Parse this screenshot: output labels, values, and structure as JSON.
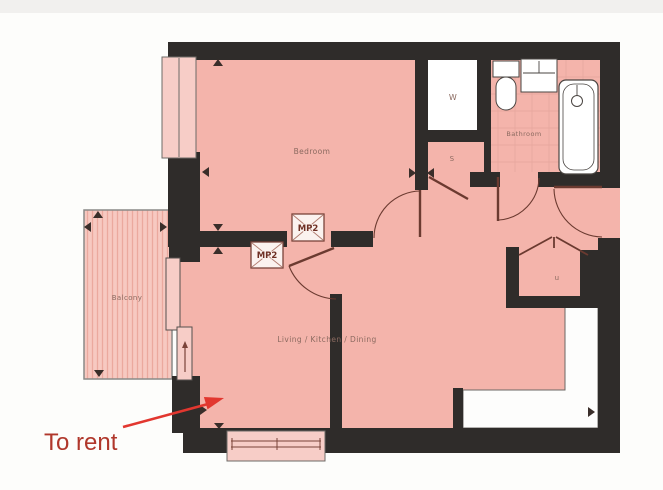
{
  "annotation": {
    "text": "To rent"
  },
  "rooms": {
    "bedroom": "Bedroom",
    "bathroom": "Bathroom",
    "balcony": "Balcony",
    "living": "Living / Kitchen / Dining"
  },
  "closets": {
    "wardrobe": "W",
    "storage": "S",
    "utility": "u"
  },
  "markers": {
    "mp2_upper": "MP2",
    "mp2_lower": "MP2"
  },
  "colors": {
    "wall": "#2f2c2a",
    "room_fill": "#f4b4ab",
    "balcony_fill": "#f7c9c1",
    "balcony_stripe": "#eba99e",
    "window_fill": "#f7cdc7",
    "fixture_white": "#ffffff",
    "door_line": "#6b3a30",
    "label_text": "#8b6a60",
    "mp2_text": "#6e2f24",
    "annotation_text": "#b0372b",
    "annotation_arrow": "#e2372f",
    "top_band": "#f1f0ee"
  }
}
